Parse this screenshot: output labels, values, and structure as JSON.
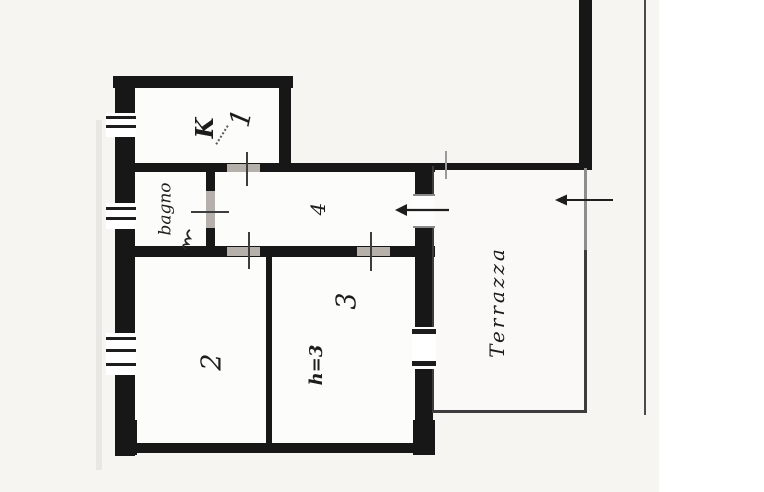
{
  "document": {
    "type": "floor-plan",
    "style": "scanned hand-drawn apartment plan, rotated 90 degrees"
  },
  "labels": {
    "kitchen": "K",
    "kitchen_number": "1",
    "bathroom": "bagno",
    "hall_number": "4",
    "room2": "2",
    "room3": "3",
    "room3_height": "h=3",
    "terrace": "Terrazza"
  },
  "icons": {
    "apartment_entrance": "left-arrow",
    "terrace_entrance": "left-arrow"
  },
  "colors": {
    "wall": "#171717",
    "paper": "#f6f5f2",
    "page": "#ffffff",
    "room_fill": "#fcfcfa",
    "door_gap": "#b5b1aa",
    "tick": "#3d3d3d",
    "ink": "#1c1c1c"
  }
}
